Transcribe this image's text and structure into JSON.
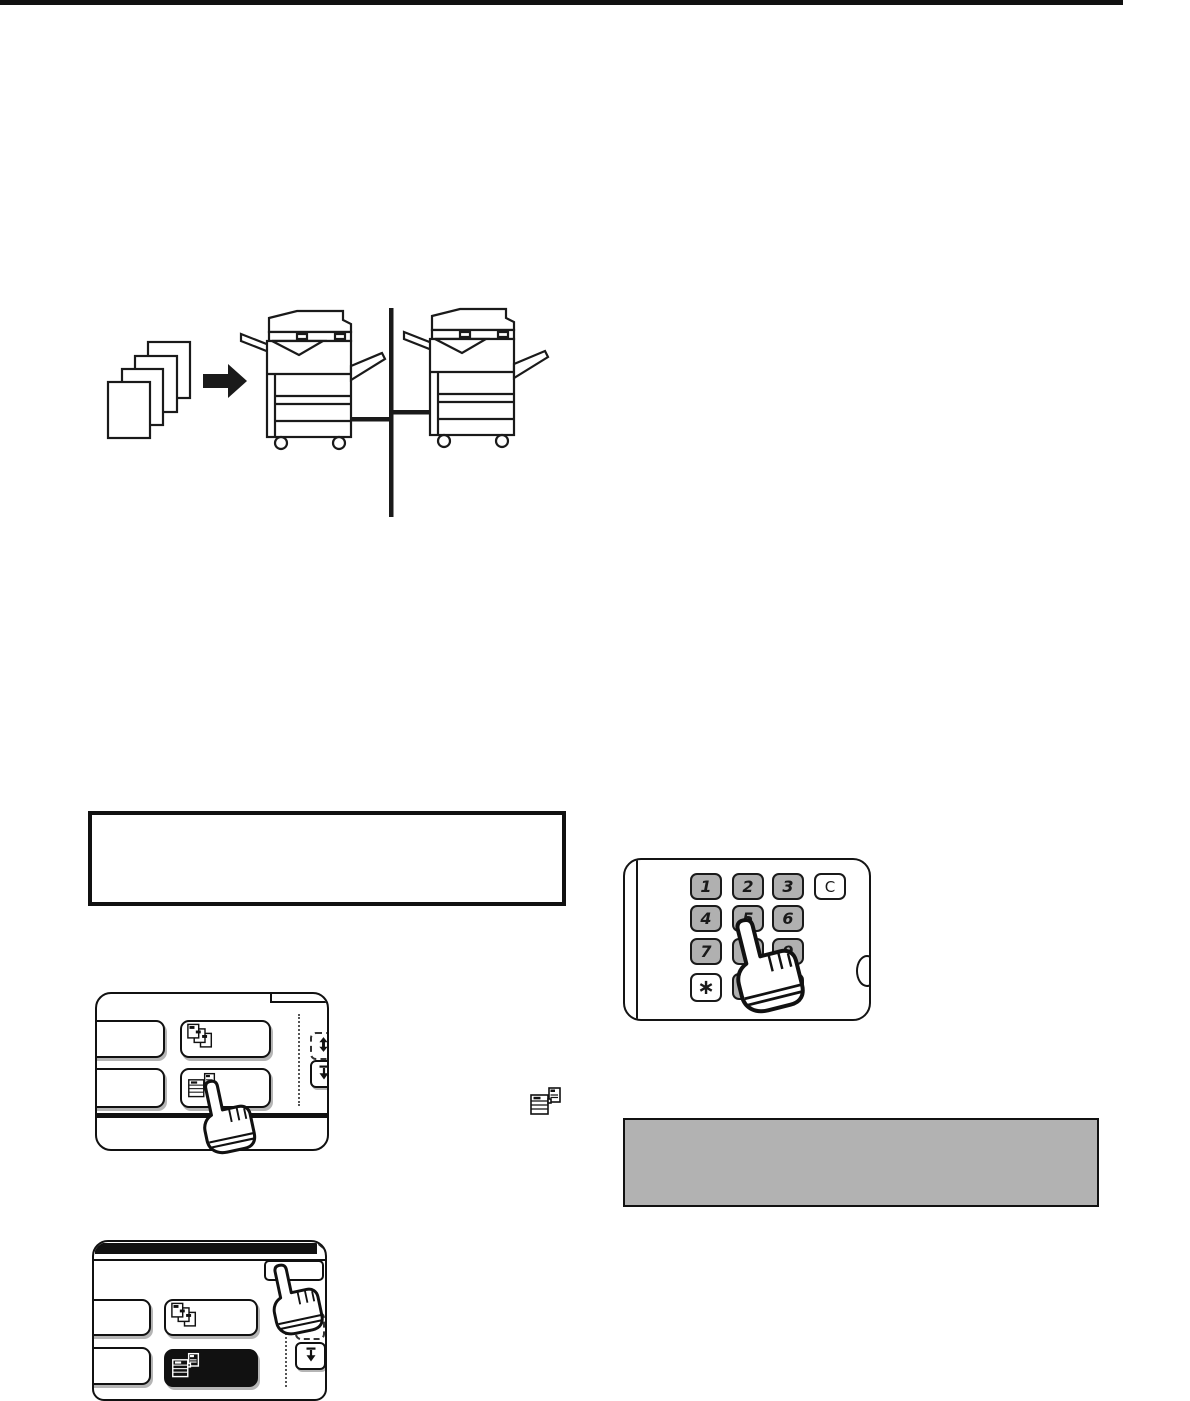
{
  "page": {
    "background": "#ffffff",
    "top_rule_color": "#111111"
  },
  "copy_network_diagram": {
    "original_sheets_count": 4,
    "arrow_icon": "solid-right-arrow",
    "machine_icon": "digital-copier",
    "machines_count": 2,
    "network_link": "vertical-line-connector"
  },
  "note_box": {
    "text": ""
  },
  "numeric_keypad": {
    "rows": [
      [
        "1",
        "2",
        "3"
      ],
      [
        "4",
        "5",
        "6"
      ],
      [
        "7",
        "8",
        "9"
      ],
      [
        "∗",
        "0",
        "#/P"
      ]
    ],
    "clear_key": "C",
    "pressed_key": "5",
    "number_key_color": "#b0b0b0",
    "function_key_color": "#ffffff",
    "hand_icon": "pointing-hand"
  },
  "touch_panel_top": {
    "buttons": [
      {
        "name": "blank-button-1",
        "label": ""
      },
      {
        "name": "document-stack-button",
        "label": "",
        "icon": "document-stack-icon"
      },
      {
        "name": "blank-button-2",
        "label": ""
      },
      {
        "name": "copier-button",
        "label": "",
        "icon": "copier-icon",
        "pressed_by_hand": true
      }
    ],
    "scroll_up_icon": "scroll-display-arrows",
    "scroll_down_icon": "down-arrow-to-bar"
  },
  "highlight_box": {
    "text": "",
    "fill": "#b2b2b2"
  },
  "inline_icon": "copier-icon",
  "touch_panel_bottom": {
    "header_bar_color": "#111111",
    "top_right_button": {
      "name": "top-right-button",
      "label": "",
      "pressed_by_hand": true
    },
    "buttons": [
      {
        "name": "blank-button-1",
        "label": ""
      },
      {
        "name": "document-stack-button",
        "label": "",
        "icon": "document-stack-icon"
      },
      {
        "name": "blank-button-2",
        "label": ""
      },
      {
        "name": "copier-button",
        "label": "",
        "icon": "copier-icon",
        "selected": true,
        "fill": "#111111"
      }
    ],
    "scroll_up_icon": "scroll-display-arrows",
    "scroll_down_icon": "down-arrow-to-bar"
  }
}
